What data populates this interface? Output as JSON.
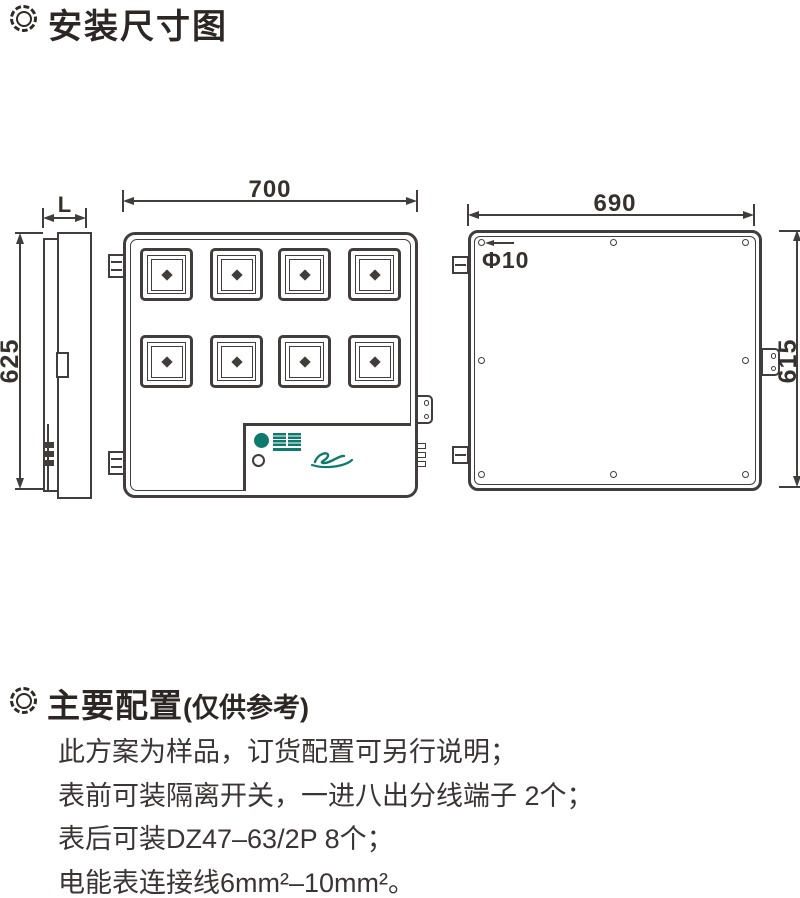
{
  "header": {
    "title": "安装尺寸图"
  },
  "installation_diagram": {
    "side_view": {
      "depth_label": "L",
      "height_label": "625"
    },
    "front_view": {
      "width_label": "700"
    },
    "back_view": {
      "width_label": "690",
      "height_label": "615",
      "hole_label": "Φ10"
    }
  },
  "config": {
    "title": "主要配置",
    "subtitle": "(仅供参考)",
    "notes": [
      "此方案为样品，订货配置可另行说明；",
      "表前可装隔离开关，一进八出分线端子 2个；",
      "表后可装DZ47–63/2P 8个；",
      "电能表连接线6mm²–10mm²。"
    ]
  },
  "colors": {
    "line": "#413d3c",
    "text": "#36312f",
    "brand_teal": "#0e7a6e"
  }
}
